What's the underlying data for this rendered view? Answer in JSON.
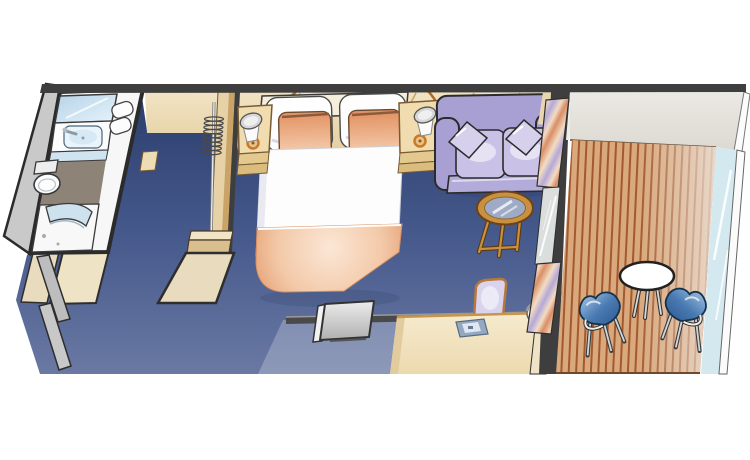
{
  "meta": {
    "kind": "floor-plan-illustration",
    "subject": "cruise ship balcony stateroom, top-down cutaway view",
    "text_labels": []
  },
  "areas": {
    "bathroom": {
      "items": [
        "mirror",
        "vanity-sink",
        "faucet",
        "towels",
        "toilet",
        "shower-with-curved-glass"
      ]
    },
    "wardrobe": {
      "items": [
        "hanging-rod",
        "hangers",
        "shoe-shelf",
        "open-closet-door"
      ]
    },
    "entry": {
      "items": [
        "entry-door-panels",
        "wall-stubs"
      ]
    },
    "bedroom": {
      "items": [
        "queen-bed",
        "white-pillows",
        "peach-pillows",
        "peach-blanket",
        "headboard-shelf",
        "nightstand-left",
        "nightstand-right",
        "lamp-left",
        "lamp-right",
        "reading-light-arms"
      ]
    },
    "sitting_area": {
      "items": [
        "sofa",
        "throw-pillows",
        "round-glass-coffee-table",
        "curtains",
        "balcony-glass-door"
      ]
    },
    "desk_area": {
      "items": [
        "desk",
        "desk-chair",
        "telephone",
        "desk-lamp",
        "wall-tv",
        "low-wall"
      ]
    },
    "balcony": {
      "items": [
        "teak-deck-planks",
        "round-white-table",
        "patio-chair-left",
        "patio-chair-right",
        "glass-railing"
      ]
    }
  },
  "colors": {
    "background": "#ffffff",
    "outline": "#2b2b2b",
    "wall_dark": "#3e3e3e",
    "low_wall": "#4a4a4a",
    "carpet_top": "#2b3e6d",
    "carpet_mid": "#46598c",
    "carpet_bottom": "#6a79a3",
    "wall_tan_light": "#f1e3c4",
    "wall_tan": "#e4cfa0",
    "panel_line": "#c9a35f",
    "bathroom_gray": "#c9c9c9",
    "bathroom_floor": "#f7f7f7",
    "bathroom_tile": "#8d8477",
    "mirror_blue_1": "#b5d2e8",
    "mirror_blue_2": "#e7f4fb",
    "sink_blue": "#eaf4fa",
    "counter_face_blue": "#cfe3f0",
    "closet_panel": "#e7d2a8",
    "closet_panel_edge": "#c9a367",
    "door_tan": "#e9dbbd",
    "door_gray": "#bdbdbd",
    "bed_white": "#fdfdfe",
    "pillow_white": "#fefefe",
    "pillow_peach_dark": "#e08c5c",
    "pillow_peach_light": "#f9d9bd",
    "blanket_center": "#fbe7d6",
    "blanket_mid": "#f3c9a8",
    "blanket_edge": "#df9565",
    "headboard_shelf": "#f6eeda",
    "nightstand_top": "#f0dcae",
    "nightstand_front": "#e3c98e",
    "lamp_ring": "#c87a28",
    "lamp_shade": "#d6d6d6",
    "reading_arm": "#b5691f",
    "sofa_base": "#a89fd2",
    "sofa_cushion": "#c9c2e6",
    "sofa_front": "#b3abd9",
    "sofa_pillow": "#d6d0ec",
    "table_wood": "#c9913f",
    "table_glass": "#9fabc6",
    "curtain_peach": "#d98e66",
    "curtain_cream": "#f2dcc4",
    "curtain_lavender": "#b5a8d8",
    "glass_pane": "#dadedd",
    "desk_top": "#f6ebcf",
    "desk_body": "#ecd9ae",
    "desk_edge": "#c8964a",
    "desk_chair_seat": "#d9d3ee",
    "desk_chair_rim": "#b5793c",
    "phone_body": "#93a8c2",
    "phone_screen": "#dfe8f0",
    "tv_light": "#ececec",
    "tv_dark": "#b0b0b0",
    "balcony_gray_1": "#ebe9e4",
    "balcony_gray_2": "#ddd9d2",
    "deck_plank": "#d9a87c",
    "deck_gap": "#a2592e",
    "railing_glass": "#d4e8f0",
    "patio_chair_light": "#a9cbe8",
    "patio_chair_mid": "#4a7ab2",
    "patio_chair_dark": "#2f5c94"
  }
}
